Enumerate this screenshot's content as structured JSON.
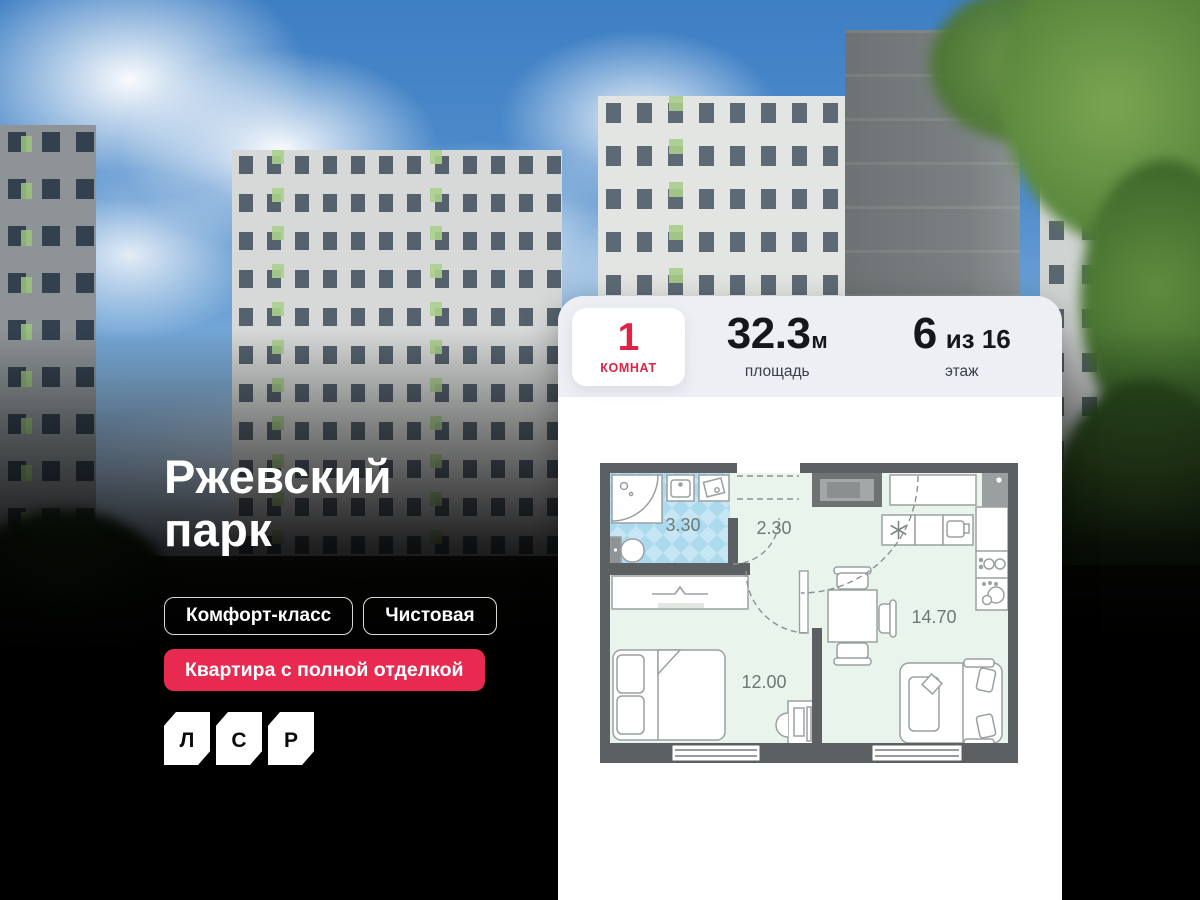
{
  "hero": {
    "title_line1": "Ржевский",
    "title_line2": "парк",
    "tags": [
      {
        "label": "Комфорт-класс"
      },
      {
        "label": "Чистовая"
      }
    ],
    "badge": "Квартира с полной отделкой",
    "logo_letters": {
      "l": "Л",
      "s": "С",
      "r": "Р"
    }
  },
  "apartment": {
    "rooms": {
      "value": "1",
      "label": "КОМНАТ"
    },
    "area": {
      "value": "32.3",
      "unit": "м",
      "label": "площадь"
    },
    "floor": {
      "value": "6",
      "of": "из 16",
      "label": "этаж"
    }
  },
  "floor_plan": {
    "bathroom_area": "3.30",
    "hallway_area": "2.30",
    "kitchen_living_area": "14.70",
    "bedroom_area": "12.00"
  },
  "colors": {
    "accent_red": "#e02245",
    "badge_red": "#e82950",
    "stats_bg": "#edeff4",
    "plan_wall": "#5c6063",
    "plan_floor": "#e9f4ec",
    "plan_bath_floor": "#c6e6f3"
  }
}
